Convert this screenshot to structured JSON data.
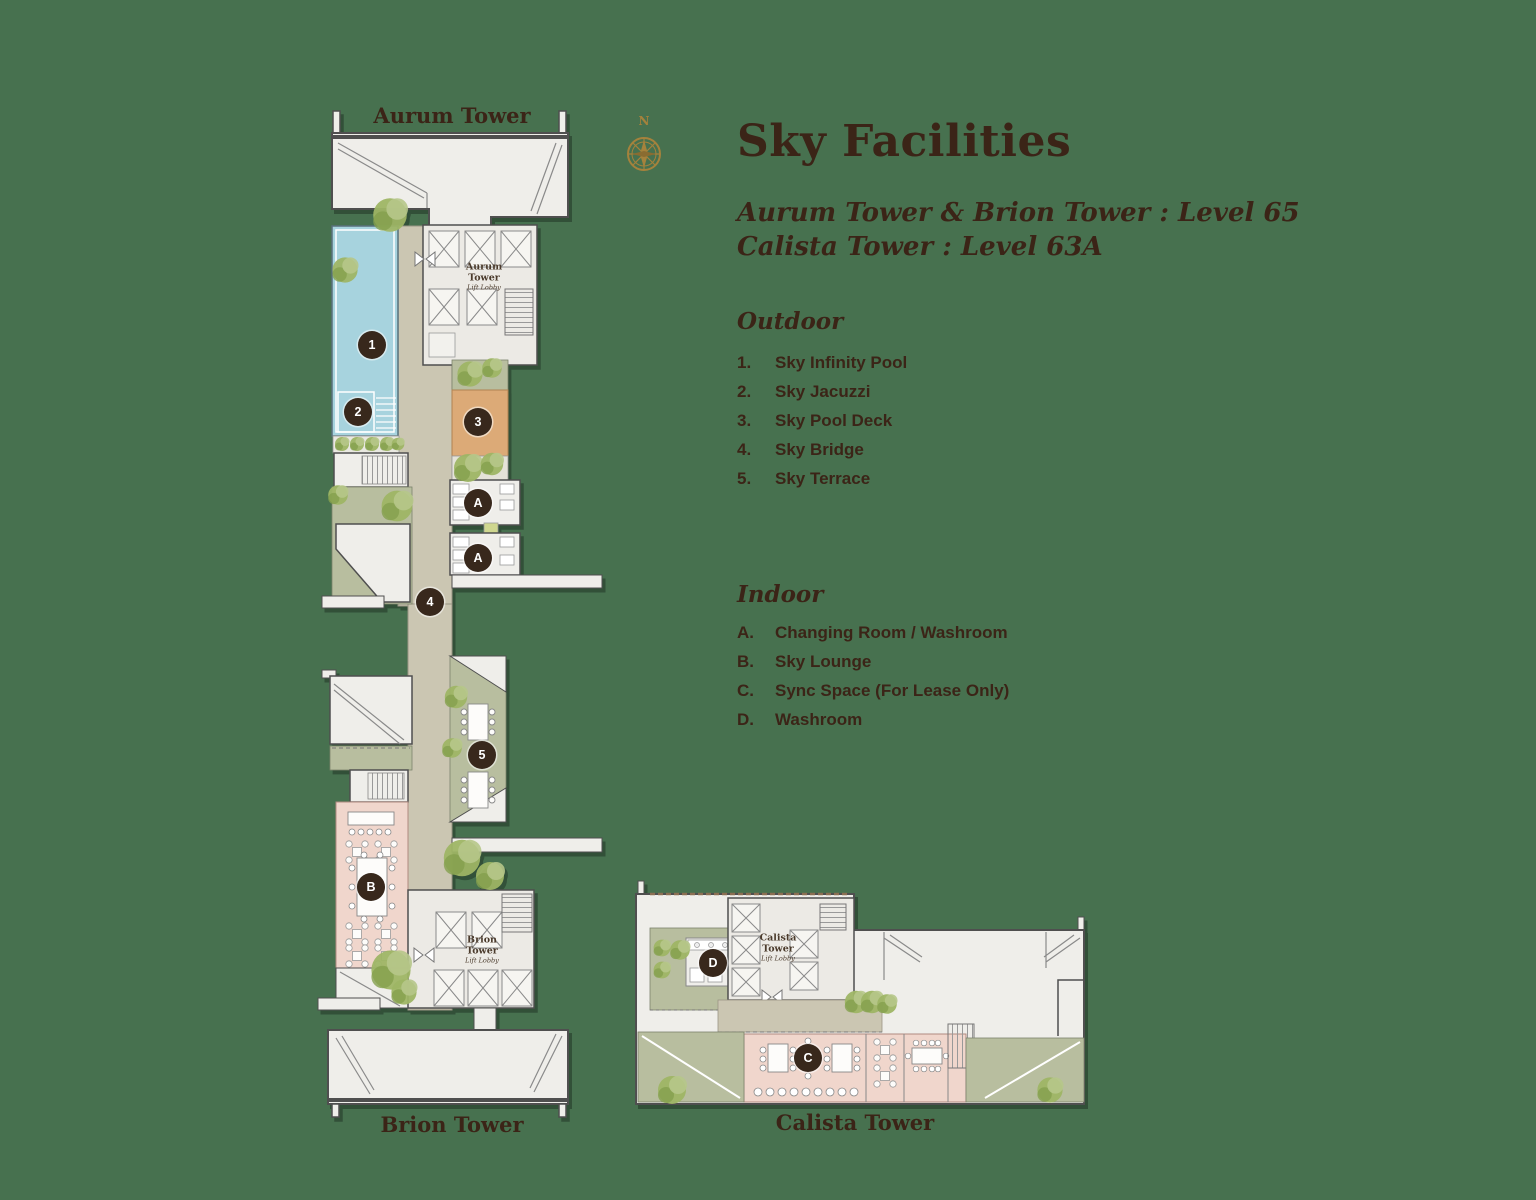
{
  "page": {
    "title": "Sky Facilities",
    "subtitle_line1": "Aurum Tower & Brion Tower : Level 65",
    "subtitle_line2": "Calista Tower : Level 63A",
    "compass_north": "N"
  },
  "legend": {
    "outdoor": {
      "header": "Outdoor",
      "items": [
        {
          "num": "1.",
          "label": "Sky Infinity Pool"
        },
        {
          "num": "2.",
          "label": "Sky Jacuzzi"
        },
        {
          "num": "3.",
          "label": "Sky Pool Deck"
        },
        {
          "num": "4.",
          "label": "Sky Bridge"
        },
        {
          "num": "5.",
          "label": "Sky Terrace"
        }
      ]
    },
    "indoor": {
      "header": "Indoor",
      "items": [
        {
          "num": "A.",
          "label": "Changing Room / Washroom"
        },
        {
          "num": "B.",
          "label": "Sky Lounge"
        },
        {
          "num": "C.",
          "label": "Sync Space (For Lease Only)"
        },
        {
          "num": "D.",
          "label": "Washroom"
        }
      ]
    }
  },
  "plan": {
    "tower_labels": {
      "aurum": "Aurum Tower",
      "brion": "Brion Tower",
      "calista": "Calista Tower"
    },
    "lift_lobbies": {
      "aurum": {
        "name_line1": "Aurum",
        "name_line2": "Tower",
        "sub": "Lift Lobby"
      },
      "brion": {
        "name_line1": "Brion",
        "name_line2": "Tower",
        "sub": "Lift Lobby"
      },
      "calista": {
        "name_line1": "Calista",
        "name_line2": "Tower",
        "sub": "Lift Lobby"
      }
    },
    "markers": [
      {
        "label": "1",
        "facility": "Sky Infinity Pool"
      },
      {
        "label": "2",
        "facility": "Sky Jacuzzi"
      },
      {
        "label": "3",
        "facility": "Sky Pool Deck"
      },
      {
        "label": "A",
        "facility": "Changing Room / Washroom"
      },
      {
        "label": "A",
        "facility": "Changing Room / Washroom"
      },
      {
        "label": "4",
        "facility": "Sky Bridge"
      },
      {
        "label": "5",
        "facility": "Sky Terrace"
      },
      {
        "label": "B",
        "facility": "Sky Lounge"
      },
      {
        "label": "D",
        "facility": "Washroom"
      },
      {
        "label": "C",
        "facility": "Sync Space (For Lease Only)"
      }
    ]
  },
  "colors": {
    "background": "#47714F",
    "heading_text": "#3B2417",
    "marker_bg": "#38281C",
    "marker_text": "#FFFFFF",
    "compass_gold": "#A5823C",
    "pool_blue": "#A7D3DE",
    "pool_deck_orange": "#DCAA77",
    "walkway_beige": "#CBC6B2",
    "terrace_green": "#B8BE9F",
    "lounge_pink": "#F0D6CC",
    "floor_light": "#EFEEEA",
    "wall_gray": "#4F4F4F",
    "tree_green": "#9EB565"
  }
}
